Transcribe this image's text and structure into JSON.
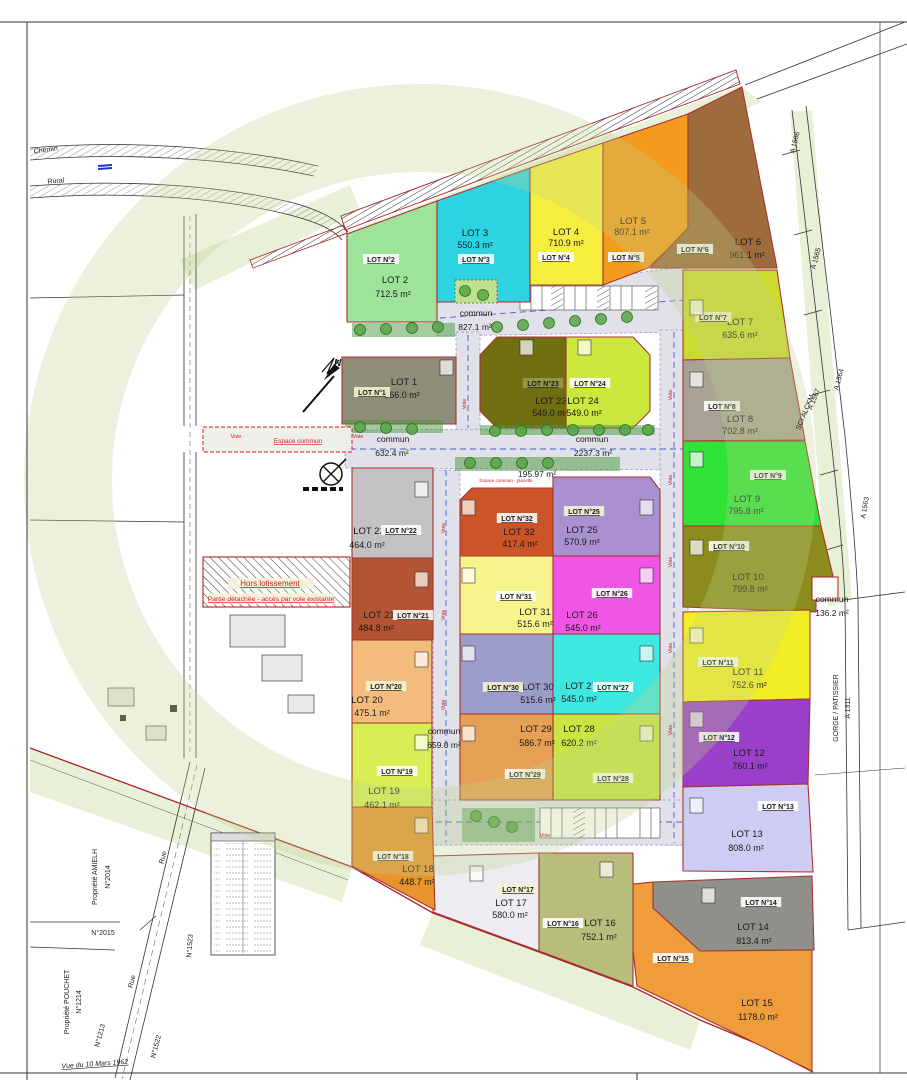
{
  "annotations": {
    "voie": "Voie",
    "espace_commun": "Espace commun",
    "espace_placette": "Espace commun - placette",
    "hors_1": "Hors lotissement",
    "hors_2": "Partie détachée - accès par voie existante",
    "rue": "Rue",
    "chemin": "Chemin",
    "rural": "Rural",
    "survey_note": "Vue du 10 Mars 1962",
    "north": "N"
  },
  "commons": {
    "c1": {
      "label": "commun",
      "area": "827.1 m²"
    },
    "c2": {
      "label": "commun",
      "area": "632.4 m²"
    },
    "c3": {
      "label": "commun",
      "area": "2237.3 m²"
    },
    "c4": {
      "area": "195.97 m²"
    },
    "c5": {
      "label": "commun",
      "area": "659.0 m²"
    },
    "c6": {
      "label": "commun",
      "area": "136.2 m²"
    }
  },
  "parcels": {
    "a1566": "A 1566",
    "a1565": "A 1565",
    "a1564": "A 1564",
    "a1567": "A 1567",
    "sci": "SCI ALCKM",
    "a1563": "A 1563",
    "gorge": "GORGE / PATISSIER",
    "a1311": "A 1311",
    "amielh": "Propriété AMIELH",
    "n2014": "N°2014",
    "n2015": "N°2015",
    "pouchet": "Propriété POUCHET",
    "n1214": "N°1214",
    "n1213": "N°1213",
    "n1522": "N°1522",
    "n1523": "N°1523"
  },
  "lots": [
    {
      "badge": "LOT N°1",
      "name": "LOT 1",
      "area": "666.0 m²",
      "color": "#8f8d77",
      "style": "tan",
      "pts": "342,357 456,357 456,424 342,424",
      "nx": 404,
      "ny": 385,
      "ax": 402,
      "ay": 398,
      "bx": 372,
      "by": 395
    },
    {
      "badge": "LOT N°2",
      "name": "LOT 2",
      "area": "712.5 m²",
      "color": "#9de49a",
      "style": "red",
      "pts": "347,234 437,201 437,322 347,322",
      "nx": 395,
      "ny": 283,
      "ax": 393,
      "ay": 297,
      "bx": 381,
      "by": 262
    },
    {
      "badge": "LOT N°3",
      "name": "LOT 3",
      "area": "550.3 m²",
      "color": "#2ed3e2",
      "style": "red",
      "pts": "437,201 530,168 530,302 437,302",
      "nx": 475,
      "ny": 236,
      "ax": 475,
      "ay": 248,
      "bx": 476,
      "by": 262
    },
    {
      "badge": "LOT N°4",
      "name": "LOT 4",
      "area": "710.9 m²",
      "color": "#f6ee3e",
      "style": "red",
      "pts": "530,168 603,143 603,285 530,285",
      "nx": 566,
      "ny": 235,
      "ax": 566,
      "ay": 246,
      "bx": 556,
      "by": 260
    },
    {
      "badge": "LOT N°5",
      "name": "LOT 5",
      "area": "807.1 m²",
      "color": "#f49a1e",
      "style": "red",
      "pts": "603,143 688,114 688,230 648,268 603,285",
      "nx": 633,
      "ny": 224,
      "ax": 632,
      "ay": 235,
      "bx": 626,
      "by": 260
    },
    {
      "badge": "LOT N°6",
      "name": "LOT 6",
      "area": "961.1 m²",
      "color": "#9e6c3c",
      "style": "red",
      "pts": "688,114 742,87 777,268 650,268 688,228",
      "nx": 748,
      "ny": 245,
      "ax": 747,
      "ay": 258,
      "bx": 695,
      "by": 252
    },
    {
      "badge": "LOT N°7",
      "name": "LOT 7",
      "area": "635.6 m²",
      "color": "#ccd92f",
      "style": "tan",
      "pts": "683,270 777,270 790,358 683,360",
      "nx": 740,
      "ny": 325,
      "ax": 740,
      "ay": 338,
      "bx": 713,
      "by": 320
    },
    {
      "badge": "LOT N°8",
      "name": "LOT 8",
      "area": "702.8 m²",
      "color": "#a9a295",
      "style": "red",
      "pts": "683,360 790,358 805,440 683,441",
      "nx": 740,
      "ny": 422,
      "ax": 740,
      "ay": 434,
      "bx": 722,
      "by": 409
    },
    {
      "badge": "LOT N°9",
      "name": "LOT 9",
      "area": "795.8 m²",
      "color": "#2fe436",
      "style": "red",
      "pts": "683,441 805,441 821,526 683,526",
      "nx": 747,
      "ny": 502,
      "ax": 746,
      "ay": 514,
      "bx": 768,
      "by": 478
    },
    {
      "badge": "LOT N°10",
      "name": "LOT 10",
      "area": "799.8 m²",
      "color": "#8b8b1e",
      "style": "red",
      "pts": "683,526 821,526 838,597 816,600 816,612 683,607",
      "nx": 748,
      "ny": 580,
      "ax": 750,
      "ay": 592,
      "bx": 729,
      "by": 549
    },
    {
      "badge": "LOT N°11",
      "name": "LOT 11",
      "area": "752.6 m²",
      "color": "#f2ee26",
      "style": "red",
      "pts": "683,612 810,610 810,699 683,702",
      "nx": 748,
      "ny": 675,
      "ax": 749,
      "ay": 688,
      "bx": 718,
      "by": 665
    },
    {
      "badge": "LOT N°12",
      "name": "LOT 12",
      "area": "760.1 m²",
      "color": "#9a3fc9",
      "style": "red",
      "pts": "683,702 810,699 808,784 683,787",
      "nx": 749,
      "ny": 756,
      "ax": 750,
      "ay": 769,
      "bx": 719,
      "by": 740
    },
    {
      "badge": "LOT N°13",
      "name": "LOT 13",
      "area": "808.0 m²",
      "color": "#cdcdf4",
      "style": "red",
      "pts": "683,787 808,784 813,872 683,871",
      "nx": 747,
      "ny": 837,
      "ax": 746,
      "ay": 851,
      "bx": 778,
      "by": 809
    },
    {
      "badge": "LOT N°14",
      "name": "LOT 14",
      "area": "813.4 m²",
      "color": "#90908a",
      "style": "red",
      "pts": "653,882 812,876 814,950 700,951 653,908",
      "nx": 753,
      "ny": 930,
      "ax": 754,
      "ay": 944,
      "bx": 761,
      "by": 905
    },
    {
      "badge": "LOT N°15",
      "name": "LOT 15",
      "area": "1178.0 m²",
      "color": "#ef9c3a",
      "style": "red",
      "pts": "633,884 653,882 653,908 700,951 812,950 812,1071 745,1038 637,986 633,950",
      "nx": 757,
      "ny": 1006,
      "ax": 758,
      "ay": 1020,
      "bx": 673,
      "by": 961
    },
    {
      "badge": "LOT N°16",
      "name": "LOT 16",
      "area": "752.1 m²",
      "color": "#b7be7c",
      "style": "red",
      "pts": "539,853 633,853 633,986 539,951",
      "nx": 600,
      "ny": 926,
      "ax": 599,
      "ay": 940,
      "bx": 563,
      "by": 926
    },
    {
      "badge": "LOT N°17",
      "name": "LOT 17",
      "area": "580.0 m²",
      "color": "#ededf1",
      "style": "tan",
      "pts": "433,856 539,853 539,951 433,912",
      "nx": 511,
      "ny": 906,
      "ax": 510,
      "ay": 918,
      "bx": 518,
      "by": 892
    },
    {
      "badge": "LOT N°18",
      "name": "LOT 18",
      "area": "448.7 m²",
      "color": "#e8932d",
      "style": "red",
      "pts": "352,807 432,807 435,910 352,866",
      "nx": 418,
      "ny": 872,
      "ax": 417,
      "ay": 885,
      "bx": 393,
      "by": 859
    },
    {
      "badge": "LOT N°19",
      "name": "LOT 19",
      "area": "462.1 m²",
      "color": "#d9ee55",
      "style": "red",
      "pts": "352,723 432,723 432,807 352,807",
      "nx": 384,
      "ny": 794,
      "ax": 382,
      "ay": 808,
      "bx": 397,
      "by": 774
    },
    {
      "badge": "LOT N°20",
      "name": "LOT 20",
      "area": "475.1 m²",
      "color": "#f1bc7c",
      "style": "tan",
      "pts": "352,640 432,640 432,723 352,723",
      "nx": 367,
      "ny": 703,
      "ax": 372,
      "ay": 716,
      "bx": 386,
      "by": 689
    },
    {
      "badge": "LOT N°21",
      "name": "LOT 21",
      "area": "484.8 m²",
      "color": "#b35432",
      "style": "red",
      "pts": "352,558 433,558 433,640 352,640",
      "nx": 379,
      "ny": 618,
      "ax": 376,
      "ay": 631,
      "bx": 413,
      "by": 618
    },
    {
      "badge": "LOT N°22",
      "name": "LOT 22",
      "area": "464.0 m²",
      "color": "#c2c2c5",
      "style": "red",
      "pts": "352,468 433,468 433,558 352,558",
      "nx": 369,
      "ny": 534,
      "ax": 367,
      "ay": 548,
      "bx": 401,
      "by": 533
    },
    {
      "badge": "LOT N°23",
      "name": "LOT 23",
      "area": "549.0 m²",
      "color": "#6f6f12",
      "style": "dark",
      "pts": "480,355 497,337 566,337 566,428 497,428 480,411",
      "nx": 551,
      "ny": 404,
      "ax": 550,
      "ay": 416,
      "bx": 543,
      "by": 386
    },
    {
      "badge": "LOT N°24",
      "name": "LOT 24",
      "area": "549.0 m²",
      "color": "#cbe83c",
      "style": "red",
      "pts": "566,337 633,337 650,355 650,411 633,428 566,428",
      "nx": 583,
      "ny": 404,
      "ax": 584,
      "ay": 416,
      "bx": 590,
      "by": 386
    },
    {
      "badge": "LOT N°25",
      "name": "LOT 25",
      "area": "570.9 m²",
      "color": "#a890d1",
      "style": "tan",
      "pts": "553,477 650,477 660,490 660,556 553,556",
      "nx": 582,
      "ny": 533,
      "ax": 582,
      "ay": 545,
      "bx": 584,
      "by": 514
    },
    {
      "badge": "LOT N°26",
      "name": "LOT 26",
      "area": "545.0 m²",
      "color": "#f055e6",
      "style": "red",
      "pts": "553,556 660,556 660,634 553,634",
      "nx": 582,
      "ny": 618,
      "ax": 583,
      "ay": 631,
      "bx": 612,
      "by": 596
    },
    {
      "badge": "LOT N°27",
      "name": "LOT 27",
      "area": "545.0 m²",
      "color": "#3ee7df",
      "style": "red",
      "pts": "553,634 660,634 660,714 553,714",
      "nx": 581,
      "ny": 689,
      "ax": 579,
      "ay": 702,
      "bx": 613,
      "by": 690
    },
    {
      "badge": "LOT N°28",
      "name": "LOT 28",
      "area": "620.2 m²",
      "color": "#c9e542",
      "style": "red",
      "pts": "553,714 660,714 660,800 553,800",
      "nx": 579,
      "ny": 732,
      "ax": 579,
      "ay": 746,
      "bx": 613,
      "by": 781
    },
    {
      "badge": "LOT N°29",
      "name": "LOT 29",
      "area": "586.7 m²",
      "color": "#e6a055",
      "style": "red",
      "pts": "460,714 553,714 553,800 460,800",
      "nx": 536,
      "ny": 732,
      "ax": 537,
      "ay": 746,
      "bx": 525,
      "by": 777
    },
    {
      "badge": "LOT N°30",
      "name": "LOT 30",
      "area": "515.6 m²",
      "color": "#9b9cc8",
      "style": "tan",
      "pts": "460,634 553,634 553,714 460,714",
      "nx": 538,
      "ny": 690,
      "ax": 538,
      "ay": 703,
      "bx": 503,
      "by": 690
    },
    {
      "badge": "LOT N°31",
      "name": "LOT 31",
      "area": "515.6 m²",
      "color": "#f5f58c",
      "style": "red",
      "pts": "460,556 553,556 553,634 460,634",
      "nx": 535,
      "ny": 615,
      "ax": 535,
      "ay": 627,
      "bx": 516,
      "by": 599
    },
    {
      "badge": "LOT N°32",
      "name": "LOT 32",
      "area": "417.4 m²",
      "color": "#cc5429",
      "style": "red",
      "pts": "460,500 472,488 553,488 553,556 460,556",
      "nx": 519,
      "ny": 535,
      "ax": 520,
      "ay": 547,
      "bx": 517,
      "by": 521
    }
  ]
}
